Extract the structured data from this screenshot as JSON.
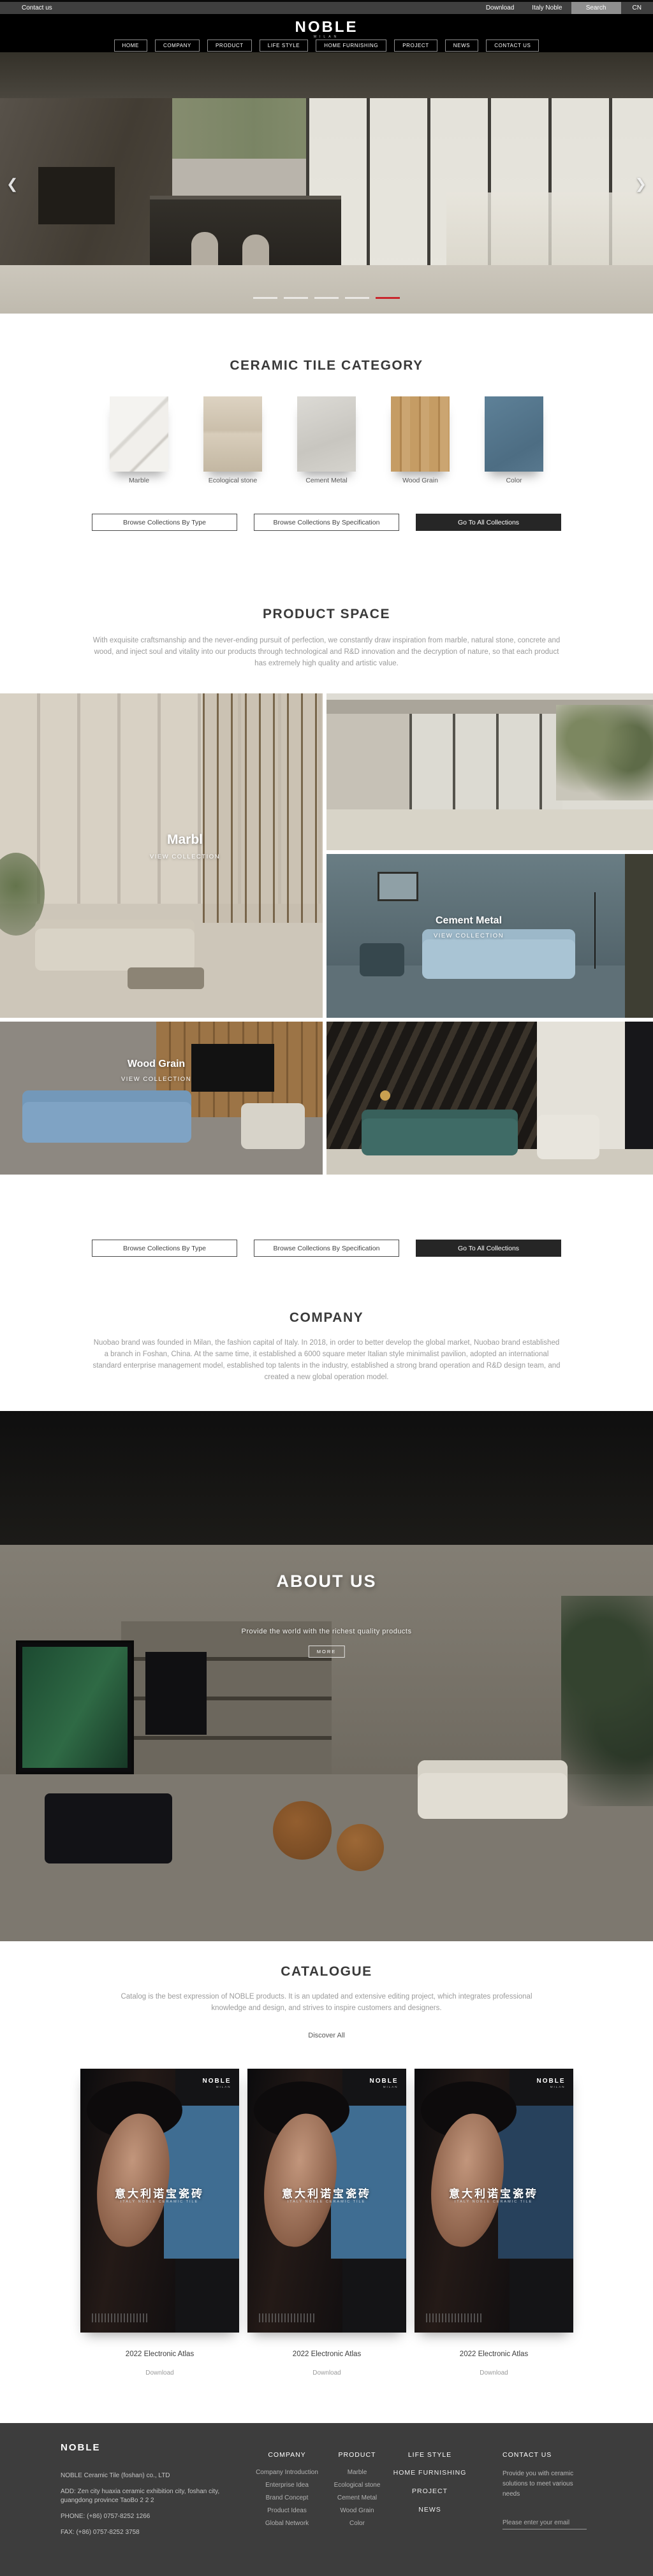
{
  "topbar": {
    "contact": "Contact us",
    "download": "Download",
    "italy": "Italy Noble",
    "search": "Search",
    "lang": "CN"
  },
  "header": {
    "logo": "NOBLE",
    "logo_sub": "MILAN",
    "nav": [
      "HOME",
      "COMPANY",
      "PRODUCT",
      "LIFE STYLE",
      "HOME FURNISHING",
      "PROJECT",
      "NEWS",
      "CONTACT US"
    ]
  },
  "icons": {
    "prev": "❮",
    "next": "❯"
  },
  "colors": {
    "accent_red": "#c9252c",
    "poster_blue": "#3f6d92",
    "footer_bg": "#3d3d3d"
  },
  "category": {
    "title": "CERAMIC TILE CATEGORY",
    "tiles": [
      {
        "label": "Marble"
      },
      {
        "label": "Ecological stone"
      },
      {
        "label": "Cement Metal"
      },
      {
        "label": "Wood Grain"
      },
      {
        "label": "Color"
      }
    ]
  },
  "collection_buttons": [
    "Browse Collections By Type",
    "Browse Collections By Specification",
    "Go To All Collections"
  ],
  "product_space": {
    "title": "PRODUCT SPACE",
    "description": "With exquisite craftsmanship and the never-ending pursuit of perfection, we constantly draw inspiration from marble, natural stone, concrete and wood, and inject soul and vitality into our products through technological and R&D innovation and the decryption of nature, so that each product has extremely high quality and artistic value.",
    "cards": [
      {
        "label": "Marbl",
        "cta": "VIEW COLLECTION"
      },
      {
        "label": "Cement Metal",
        "cta": "VIEW COLLECTION"
      },
      {
        "label": "Wood Grain",
        "cta": "VIEW COLLECTION"
      }
    ]
  },
  "company": {
    "title": "COMPANY",
    "description": "Nuobao brand was founded in Milan, the fashion capital of Italy. In 2018, in order to better develop the global market, Nuobao brand established a branch in Foshan, China. At the same time, it established a 6000 square meter Italian style minimalist pavilion, adopted an international standard enterprise management model, established top talents in the industry, established a strong brand operation and R&D design team, and created a new global operation model."
  },
  "about": {
    "title": "ABOUT US",
    "caption": "Provide the world with the richest quality products",
    "more_label": "MORE"
  },
  "catalogue": {
    "title": "CATALOGUE",
    "description": "Catalog is the best expression of NOBLE products. It is an updated and extensive editing project, which integrates professional knowledge and design, and strives to inspire customers and designers.",
    "discover": "Discover All",
    "poster": {
      "brand": "NOBLE",
      "brand_sub": "MILAN",
      "headline": "意大利诺宝瓷砖",
      "subline": "ITALY NOBLE CERAMIC TILE"
    },
    "items": [
      {
        "title": "2022 Electronic Atlas",
        "action": "Download"
      },
      {
        "title": "2022 Electronic Atlas",
        "action": "Download"
      },
      {
        "title": "2022 Electronic Atlas",
        "action": "Download"
      }
    ]
  },
  "footer": {
    "brand": "NOBLE",
    "company_line": "NOBLE Ceramic Tile (foshan) co., LTD",
    "address": "ADD:  Zen city huaxia ceramic exhibition city, foshan city, guangdong province TaoBo 2 2 2",
    "phone": "PHONE:   (+86)  0757-8252 1266",
    "fax": "FAX:   (+86)  0757-8252 3758",
    "columns": [
      {
        "header": "COMPANY",
        "items": [
          "Company Introduction",
          "Enterprise Idea",
          "Brand Concept",
          "Product Ideas",
          "Global Network"
        ]
      },
      {
        "header": "PRODUCT",
        "items": [
          "Marble",
          "Ecological stone",
          "Cement Metal",
          "Wood Grain",
          "Color"
        ]
      },
      {
        "header": "LIFE STYLE",
        "items": [
          "HOME FURNISHING",
          "PROJECT",
          "NEWS"
        ]
      },
      {
        "header": "CONTACT US",
        "text": "Provide you with ceramic solutions to meet various needs",
        "email_placeholder": "Please enter your email"
      }
    ]
  }
}
